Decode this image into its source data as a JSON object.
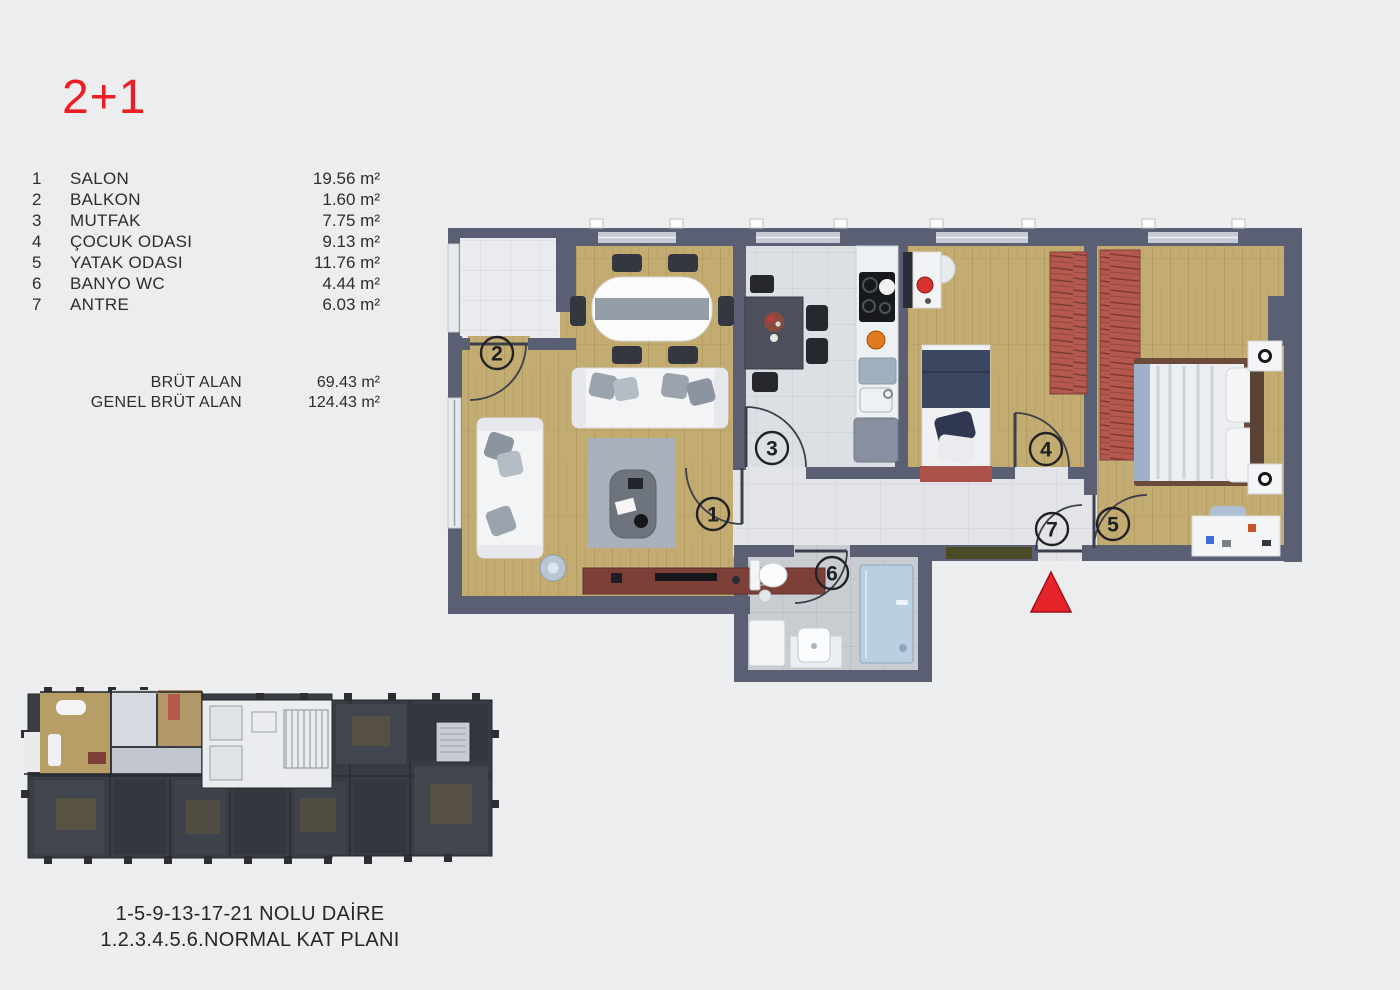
{
  "header": {
    "title": "2+1"
  },
  "legend": {
    "rooms": [
      {
        "num": "1",
        "label": "SALON",
        "area": "19.56 m²"
      },
      {
        "num": "2",
        "label": "BALKON",
        "area": "1.60 m²"
      },
      {
        "num": "3",
        "label": "MUTFAK",
        "area": "7.75 m²"
      },
      {
        "num": "4",
        "label": "ÇOCUK ODASI",
        "area": "9.13 m²"
      },
      {
        "num": "5",
        "label": "YATAK ODASI",
        "area": "11.76 m²"
      },
      {
        "num": "6",
        "label": "BANYO WC",
        "area": "4.44 m²"
      },
      {
        "num": "7",
        "label": "ANTRE",
        "area": "6.03 m²"
      }
    ],
    "totals": [
      {
        "label": "BRÜT ALAN",
        "value": "69.43 m²"
      },
      {
        "label": "GENEL BRÜT ALAN",
        "value": "124.43 m²"
      }
    ]
  },
  "floor_plan": {
    "markers": [
      "1",
      "2",
      "3",
      "4",
      "5",
      "6",
      "7"
    ],
    "entrance_icon": "entrance-triangle"
  },
  "caption": {
    "line1": "1-5-9-13-17-21 NOLU DAİRE",
    "line2": "1.2.3.4.5.6.NORMAL KAT PLANI"
  },
  "colors": {
    "accent_red": "#e8242b",
    "title_red": "#ee1d23",
    "wall": "#5a5f73",
    "wood_floor": "#c2ac71",
    "kitchen_tile": "#dce0e5",
    "bath_tile": "#c9cdd2",
    "hall_tile": "#e2e4e8",
    "balcony_tile": "#e9ebee",
    "wardrobe_red": "#b5584e",
    "tv_unit": "#7c4038",
    "doormat_olive": "#4c4b28",
    "mini_plan_dark": "#3a3d45"
  }
}
